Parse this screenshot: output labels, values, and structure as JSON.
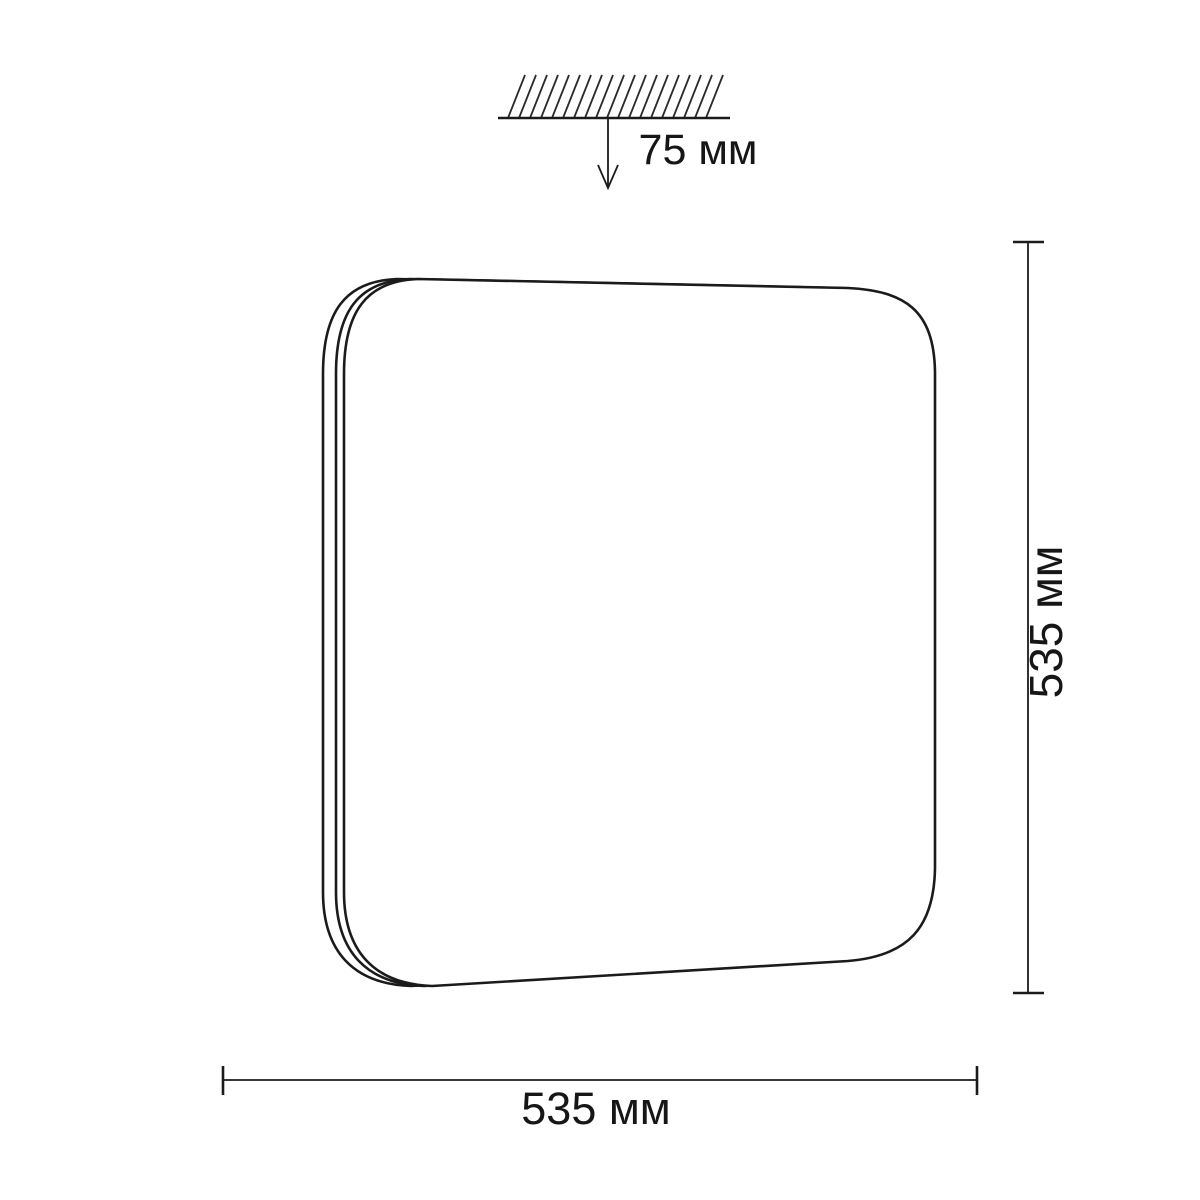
{
  "page": {
    "background_color": "#ffffff",
    "line_color": "#1b1b1b"
  },
  "diagram": {
    "ceiling_offset": {
      "label": "75 мм",
      "value_mm": 75
    },
    "height_dimension": {
      "label": "535 мм",
      "value_mm": 535
    },
    "width_dimension": {
      "label": "535 мм",
      "value_mm": 535
    }
  }
}
